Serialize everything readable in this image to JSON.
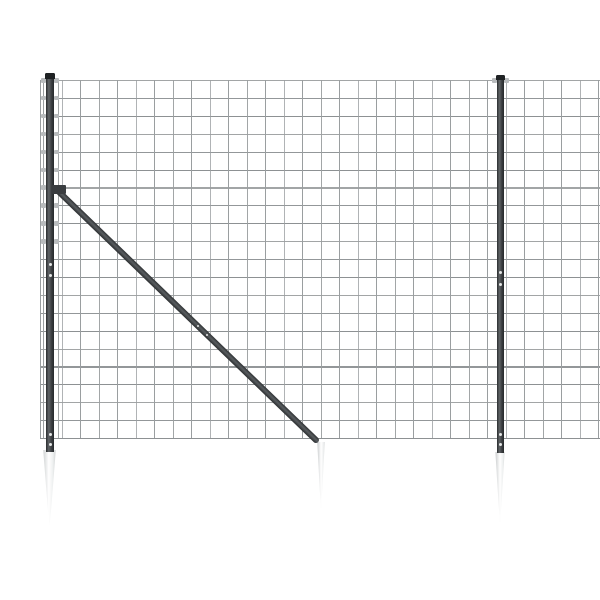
{
  "image": {
    "description": "Product photograph of an anthracite wire mesh garden fence panel with two posts, a diagonal brace and three white ground anchor spikes on a plain white background",
    "width": 600,
    "height": 600,
    "background": "#ffffff"
  },
  "colors": {
    "wire_horizontal": "#8d9193",
    "wire_vertical": "#9a9ea0",
    "post_gradient": "linear-gradient(90deg,#2a2d2f 0%,#606467 35%,#3a3d40 70%,#26292b 100%)",
    "post_cap": "#1f2224",
    "brace_gradient": "linear-gradient(180deg,#2e3133 0%,#595d60 45%,#2b2e30 100%)",
    "bracket": "#3a3d40",
    "clamp": "#b9bcbe",
    "screw": "#e4e6e6",
    "spike_gradient": "linear-gradient(90deg,#c8cbcc 0%,#ffffff 45%,#eef0f0 72%,#c6c9ca 100%)"
  },
  "mesh": {
    "left": 39.5,
    "right": 600,
    "top": 80,
    "bottom": 438,
    "h_count": 21,
    "h_step": 17.9,
    "v_extra": [
      39.5,
      57.5
    ],
    "v_start": 43,
    "v_step": 18.5,
    "v_count": 31,
    "wire_thickness": 1.2
  },
  "posts": [
    {
      "id": "left",
      "cx": 50,
      "width": 8,
      "top": 73,
      "bottom": 452,
      "cap": {
        "width": 10,
        "height": 6
      },
      "clamp_rows": [
        0,
        1,
        2,
        3,
        4,
        5,
        6,
        7,
        8,
        9
      ],
      "screws": [
        263,
        274,
        433,
        443
      ]
    },
    {
      "id": "right",
      "cx": 500,
      "width": 7,
      "top": 75,
      "bottom": 453,
      "cap": {
        "width": 9,
        "height": 5
      },
      "clamp_rows": [
        0
      ],
      "screws": [
        271,
        283,
        433,
        443
      ]
    }
  ],
  "brace": {
    "x1": 57,
    "y1": 190,
    "x2": 318,
    "y2": 442,
    "thickness": 6,
    "bracket": {
      "x": 52,
      "y": 185,
      "width": 14,
      "height": 9
    },
    "screw_fractions": [
      0.54,
      0.575
    ]
  },
  "spikes": [
    {
      "id": "left",
      "cx": 49.5,
      "top": 450,
      "width": 15,
      "height": 75
    },
    {
      "id": "middle",
      "cx": 321,
      "top": 442,
      "width": 9,
      "height": 66
    },
    {
      "id": "right",
      "cx": 500,
      "top": 452,
      "width": 11,
      "height": 70
    }
  ]
}
